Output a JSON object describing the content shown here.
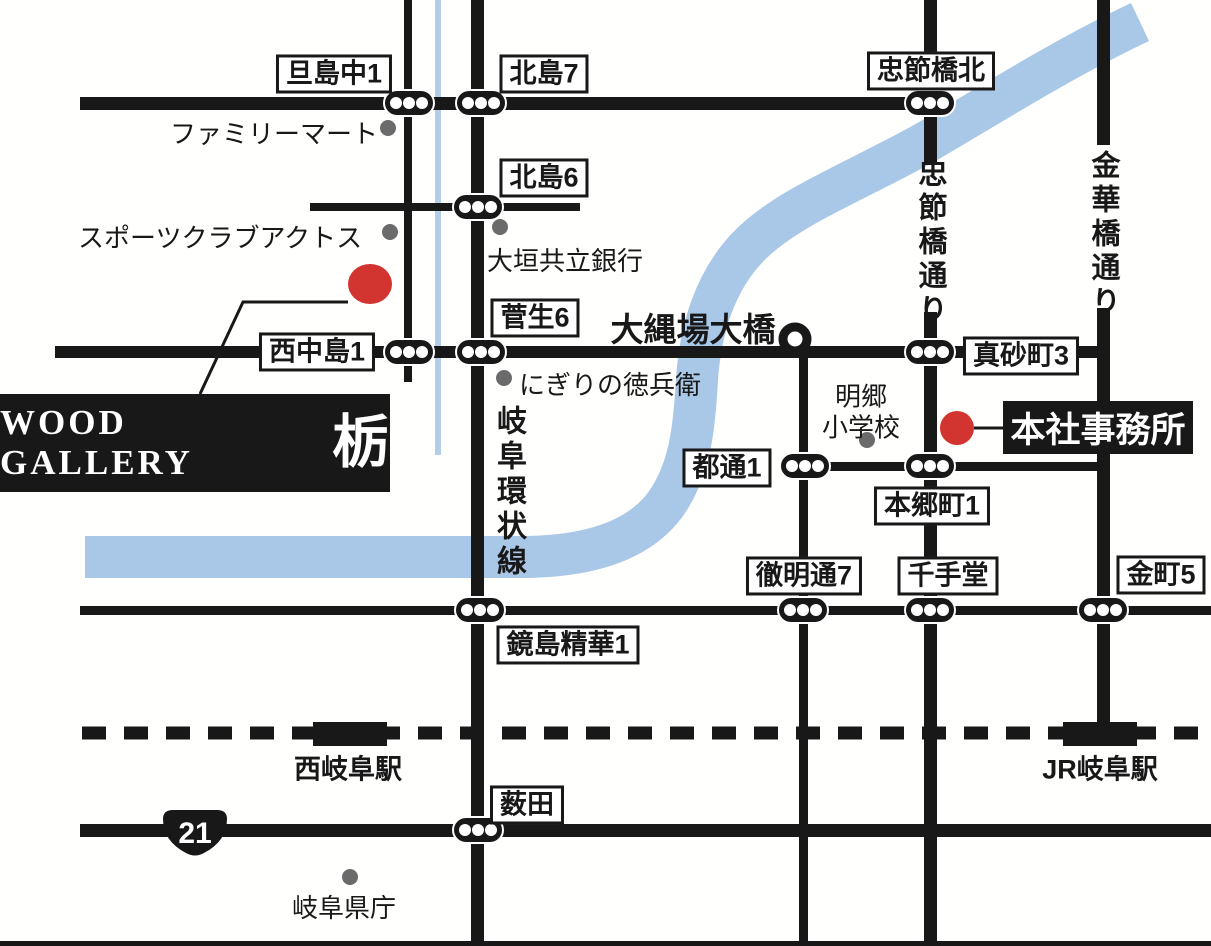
{
  "company": {
    "logo_text": "WOOD GALLERY",
    "logo_mark": "栃",
    "head_office": "本社事務所"
  },
  "intersections": {
    "tanjima_naka1": "旦島中1",
    "kitajima7": "北島7",
    "chusetsubashi_kita": "忠節橋北",
    "kitajima6": "北島6",
    "sugao6": "菅生6",
    "nishinakajima1": "西中島1",
    "masagocho3": "真砂町3",
    "miyakodori1": "都通1",
    "hongocho1": "本郷町1",
    "tetsumeidori7": "徹明通7",
    "senjudo": "千手堂",
    "kanamachi5": "金町5",
    "kagashima_seika1": "鏡島精華1",
    "yabuta": "薮田"
  },
  "landmarks": {
    "family_mart": "ファミリーマート",
    "sports_club_actos": "スポーツクラブアクトス",
    "ogaki_kyoritsu_bank": "大垣共立銀行",
    "nigiri_no_tokubei": "にぎりの徳兵衛",
    "meigo_elementary": "明郷\n小学校",
    "gifu_pref_office": "岐阜県庁"
  },
  "roads": {
    "gifu_kanjosen": "岐阜環状線",
    "chusetsubashi_dori": "忠節橋通り",
    "kinkabashi_dori": "金華橋通り"
  },
  "bridge": {
    "onawaba_ohashi": "大縄場大橋"
  },
  "stations": {
    "nishi_gifu": "西岐阜駅",
    "jr_gifu": "JR岐阜駅"
  },
  "route_badge": "21",
  "colors": {
    "road": "#181818",
    "river": "#a9c7e7",
    "stream": "#b3cde9",
    "marker_red": "#d2342f",
    "poi_gray": "#6b6b6b"
  }
}
